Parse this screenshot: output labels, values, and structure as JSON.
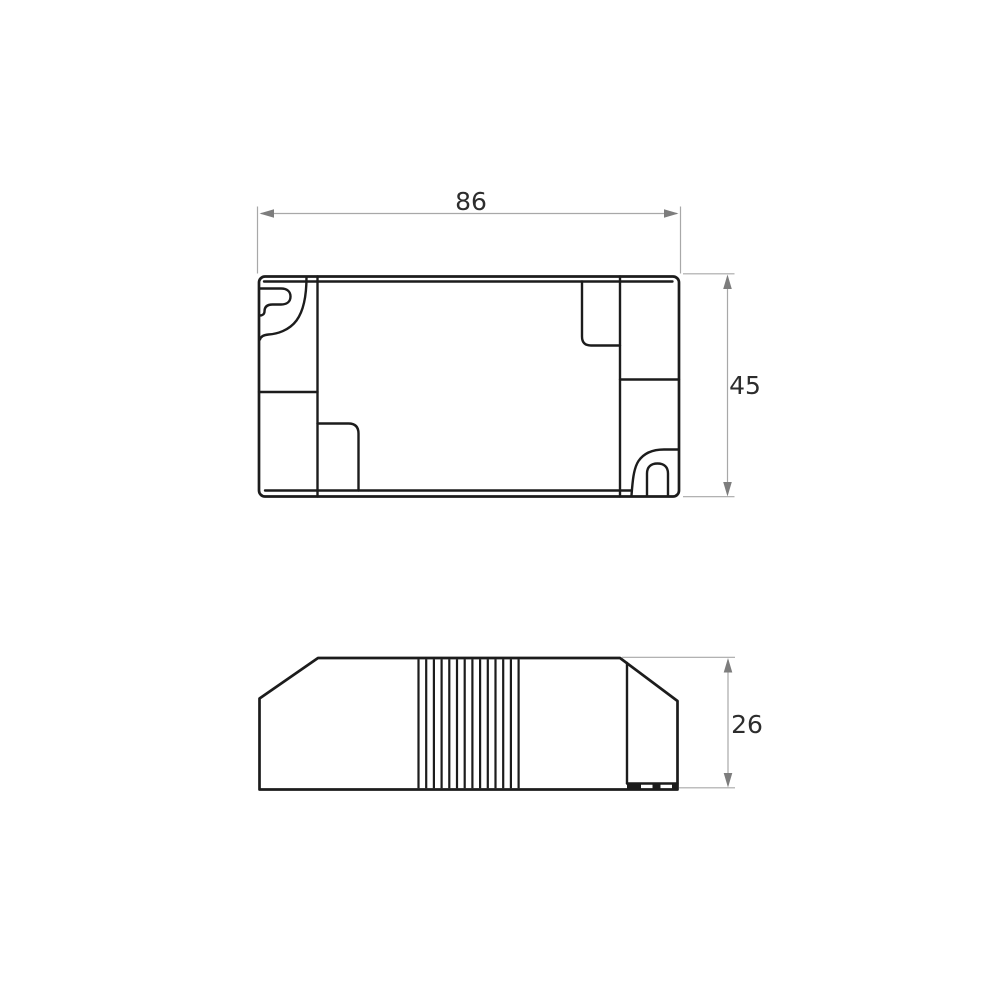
{
  "drawing": {
    "title": "enclosure dimension drawing",
    "views": {
      "top_view": {
        "name": "top-view",
        "width_label": "86",
        "height_label": "45"
      },
      "side_view": {
        "name": "side-view",
        "height_label": "26"
      }
    }
  },
  "colors": {
    "background": "#ffffff",
    "line": "#1c1c1c",
    "dim-line": "#a8a8a8",
    "arrow": "#7d7d7d",
    "text": "#2d2d2d"
  }
}
